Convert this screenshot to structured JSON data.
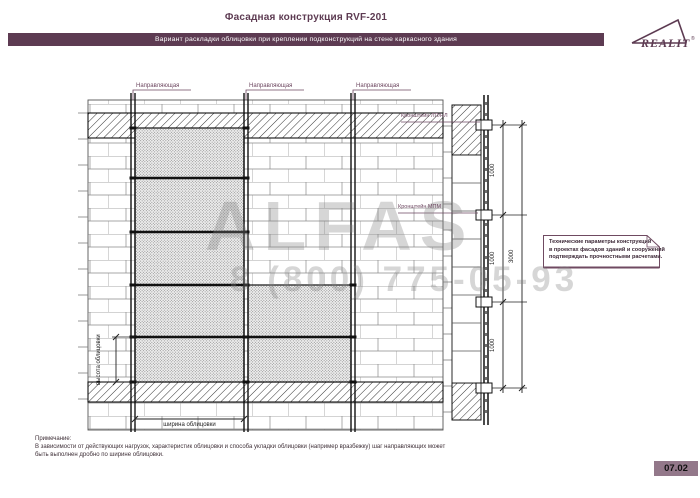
{
  "header": {
    "title": "Фасадная конструкция RVF-201",
    "subtitle": "Вариант раскладки облицовки при креплении подконструкций на стене каркасного здания",
    "logo_text": "REALIT",
    "logo_reg": "®"
  },
  "drawing": {
    "rail_labels": [
      "Направляющая",
      "Направляющая",
      "Направляющая"
    ],
    "bracket_label_top": "Кронштейн ЛП/НЛ",
    "bracket_label_mid": "Кронштейн МПМ",
    "dim_height_label": "высота облицовки",
    "dim_width_label": "ширина облицовки",
    "dims_1000": [
      "1000",
      "1000",
      "1000"
    ],
    "dim_total": "3000"
  },
  "note_box": {
    "lines": [
      "Технические параметры конструкций",
      "в проектах фасадов зданий и сооружений",
      "подтверждать прочностными расчетами."
    ]
  },
  "footnote": {
    "title": "Примечание:",
    "line1": "В зависимости от действующих нагрузок, характеристик облицовки и способа укладки облицовки (например вразбежку) шаг направляющих может",
    "line2": "быть выполнен дробно по ширине облицовки."
  },
  "footer": {
    "page_number": "07.02"
  },
  "watermark": {
    "name": "ALFAS",
    "phone": "8 (800) 775-05-93"
  },
  "colors": {
    "accent": "#5d3b52",
    "bar_bg": "#5d3b52",
    "label_ink": "#6d4760",
    "ink": "#1a1a1a",
    "pagebox_bg": "#93788a"
  }
}
